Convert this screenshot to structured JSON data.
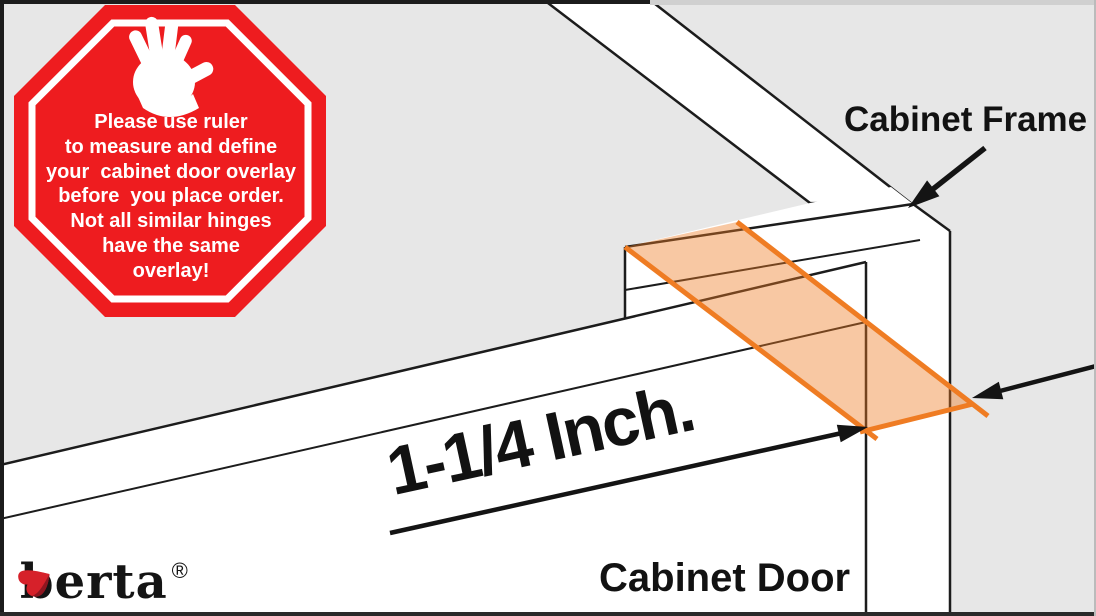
{
  "scene": {
    "background_color": "#e7e7e7",
    "line_color": "#1c1c1c",
    "face_color": "#ffffff",
    "overlay_fill": "#ef7c23",
    "overlay_stroke": "#ef7c23",
    "arrow_color": "#141414"
  },
  "stop_sign": {
    "shape": "octagon",
    "color": "#ee1c1f",
    "ring_color": "#ffffff",
    "icon": "stop-hand-icon",
    "lines": [
      "Please use ruler",
      "to measure and define",
      "your  cabinet door overlay",
      "before  you place order.",
      "Not all similar hinges",
      "have the same",
      "overlay!"
    ]
  },
  "labels": {
    "cabinet_frame": "Cabinet Frame",
    "cabinet_door": "Cabinet Door",
    "measurement": "1-1/4 Inch.",
    "overlay_value": "1-1/4",
    "overlay_unit": "Inch"
  },
  "brand": {
    "name": "berta",
    "registered": "®",
    "icon_color": "#d6212a"
  }
}
